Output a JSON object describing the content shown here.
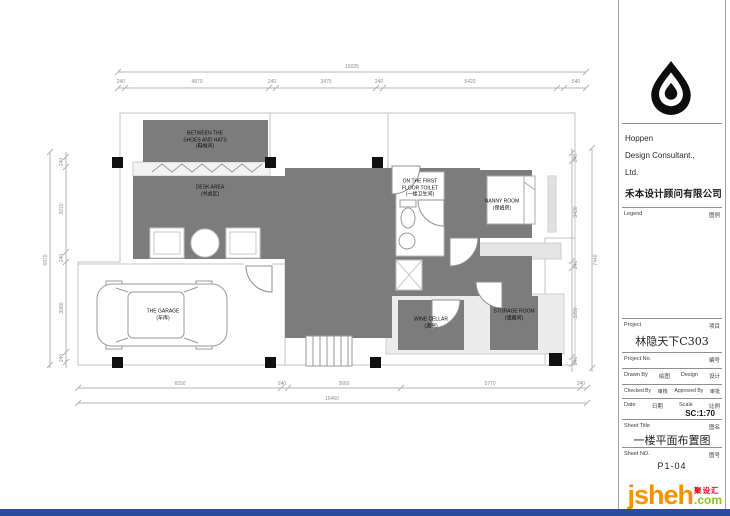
{
  "brand": {
    "logo": "hoppen-drop-logo",
    "name_line1": "Hoppen",
    "name_line2": "Design Consultant.,",
    "name_line3": "Ltd.",
    "name_cn": "禾本设计顾问有限公司",
    "legend_label": "Legend",
    "legend_label_cn": "图例"
  },
  "titleblock": {
    "project_label": "Project",
    "project_label_cn": "项目",
    "project_name": "林隐天下C303",
    "project_no_label": "Project    No.",
    "project_no_cn": "编号",
    "drawn_by_label": "Drawn By",
    "drawn_by_cn": "绘图",
    "design_label": "Design",
    "design_cn": "设计",
    "checked_by_label": "Checked By",
    "checked_by_cn": "审核",
    "approved_by_label": "Approved By",
    "approved_by_cn": "审批",
    "date_label": "Date",
    "date_cn": "日期",
    "scale_label": "Scale",
    "scale_cn": "比例",
    "scale_value": "SC:1:70",
    "sheet_title_label": "Sheet  Title",
    "sheet_title_cn": "图名",
    "sheet_title": "一楼平面布置图",
    "sheet_no_label": "Sheet  NO.",
    "sheet_no_cn": "图号",
    "sheet_no": "P1-04"
  },
  "watermark": {
    "word": "jsheh",
    "tld": ".com",
    "badge_cn": "聚设汇",
    "orange": "#f29400",
    "green": "#8dc21f",
    "red": "#e60012"
  },
  "colors": {
    "room_fill": "#7c7c7c",
    "wall_line": "#c4c4c4",
    "footer_bar": "#2a4d9b"
  },
  "plan": {
    "closet": {
      "l1": "BETWEEN THE",
      "l2": "SHOES AND HATS",
      "cn": "(鞋帽间)"
    },
    "desk": {
      "l1": "DESK AREA",
      "cn": "(书桌区)"
    },
    "toilet": {
      "l1": "ON THE FIRST",
      "l2": "FLOOR TOILET",
      "cn": "(一楼卫生间)"
    },
    "nanny": {
      "l1": "NANNY ROOM",
      "cn": "(保姆房)"
    },
    "wine": {
      "l1": "WINE  CELLAR",
      "cn": "(酒窖)"
    },
    "storage": {
      "l1": "STORAGE ROOM",
      "cn": "(储藏间)"
    },
    "garage": {
      "l1": "THE GARAGE",
      "cn": "(车库)"
    }
  },
  "dims": {
    "top_total": "15025",
    "top": [
      "240",
      "4870",
      "240",
      "3475",
      "240",
      "5420",
      "540"
    ],
    "bottom": [
      "6550",
      "240",
      "3660",
      "5770",
      "240"
    ],
    "bottom_total": "16460",
    "left": [
      "240",
      "3070",
      "240",
      "3080",
      "240"
    ],
    "left_total": "6870",
    "right": [
      "240",
      "3430",
      "240",
      "3290",
      "240"
    ],
    "right_total": "7440"
  }
}
